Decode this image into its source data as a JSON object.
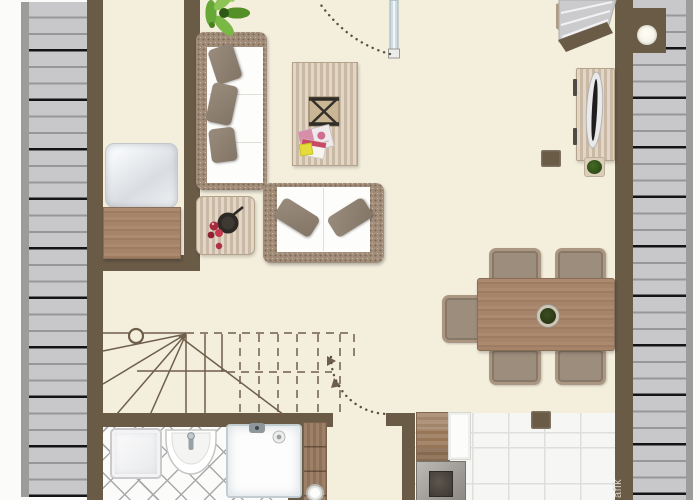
{
  "watermark": {
    "text": "afik"
  },
  "palette": {
    "page_bg": "#fbfbf9",
    "wall": "#6a5b47",
    "floor": "#f4eedd",
    "deck_plank": "#c8c8ca",
    "deck_border": "#9c9c9a",
    "wood_light": "#d6c7b2",
    "wicker": "#a18d7a",
    "cushion_white": "#fdfdfc",
    "pillow_taupe": "#837566",
    "chair_seat": "#9c8d7d",
    "tile_white": "#fbfbf9",
    "tile_line": "#a9a9ab",
    "kitchen_tile": "#f6f6f4",
    "kitchen_grout": "#dededc",
    "plant_green": "#66a735",
    "line_brown": "#6e5f4b",
    "glass": "#cfdce1"
  },
  "floor_plan": {
    "type": "residential floor plan, top-down 2D view, no text labels",
    "areas": [
      "side-terrace-left",
      "side-terrace-right",
      "utility-room",
      "living-area",
      "dining-area",
      "stair-hall",
      "bathroom",
      "corridor",
      "kitchen"
    ],
    "furniture": [
      "potted-plant",
      "corner-sofa",
      "loveseat",
      "coffee-table",
      "decor-tray",
      "magazines",
      "side-table",
      "fruit-bowl",
      "tv-sideboard",
      "television",
      "stool",
      "planter",
      "chimney",
      "dining-table",
      "dining-chairs-x5",
      "centerpiece-bowl",
      "winder-staircase",
      "balcony-door",
      "entrance-steps",
      "washing-machine",
      "washbasin",
      "shower",
      "hall-cabinet",
      "vase",
      "kitchen-cabinet",
      "kitchen-counter",
      "stove",
      "pillar",
      "daybed",
      "dresser"
    ]
  }
}
